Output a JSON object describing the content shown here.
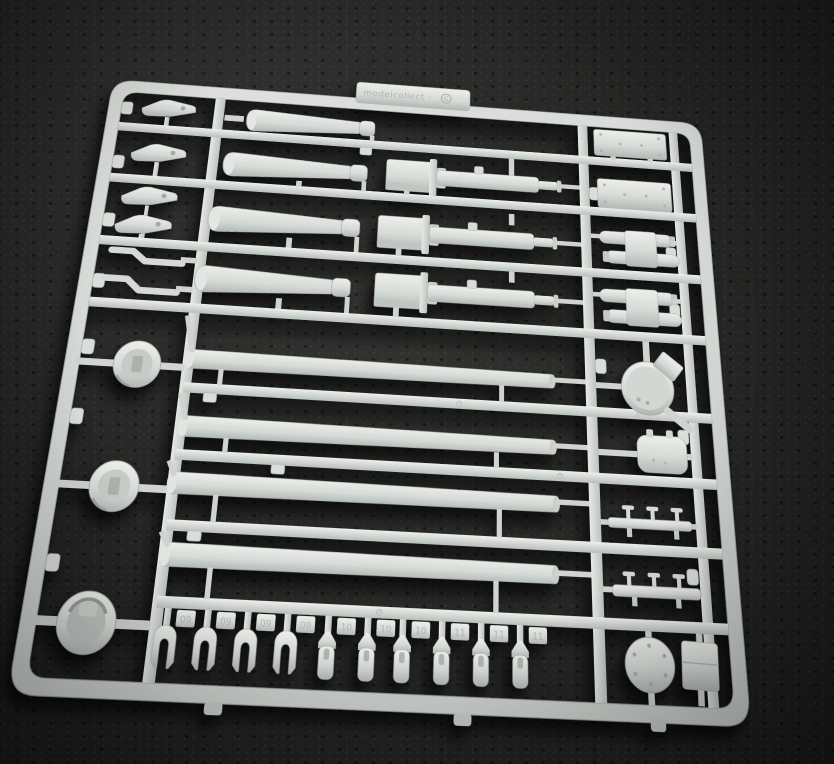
{
  "image": {
    "kind": "photograph",
    "subject": "light gray injection-molded model kit parts sprue photographed on dark charcoal felt",
    "perspective": "slight top-down angle, sprue wider at bottom of frame"
  },
  "colors": {
    "background": "#212121",
    "background_speckle": "#3a3a38",
    "plastic_highlight": "#edefeb",
    "plastic_mid": "#d5dad6",
    "plastic_shadow": "#b4bab6",
    "emboss_text": "#aab0ac",
    "cast_shadow": "rgba(0,0,0,0.55)"
  },
  "sprue": {
    "brand_label": "modelcollect -",
    "sprue_letter": "G",
    "number_tabs": [
      "09",
      "09",
      "09",
      "09",
      "10",
      "10",
      "10",
      "11",
      "11",
      "11"
    ],
    "part_groups": [
      "tapered-barrel-jacket x4",
      "gun-breech-assembly x3",
      "long-gun-barrel x4",
      "engine-deck-panel x2",
      "twin-fuel-tank-set x2",
      "turret-hatch-disc",
      "rounded-hatch",
      "handrail x2",
      "ring-mount x2",
      "drum-cupola",
      "wedge-clip x4",
      "s-bracket x2",
      "clevis-fork x10",
      "bolted-disc",
      "stowage-box"
    ]
  }
}
